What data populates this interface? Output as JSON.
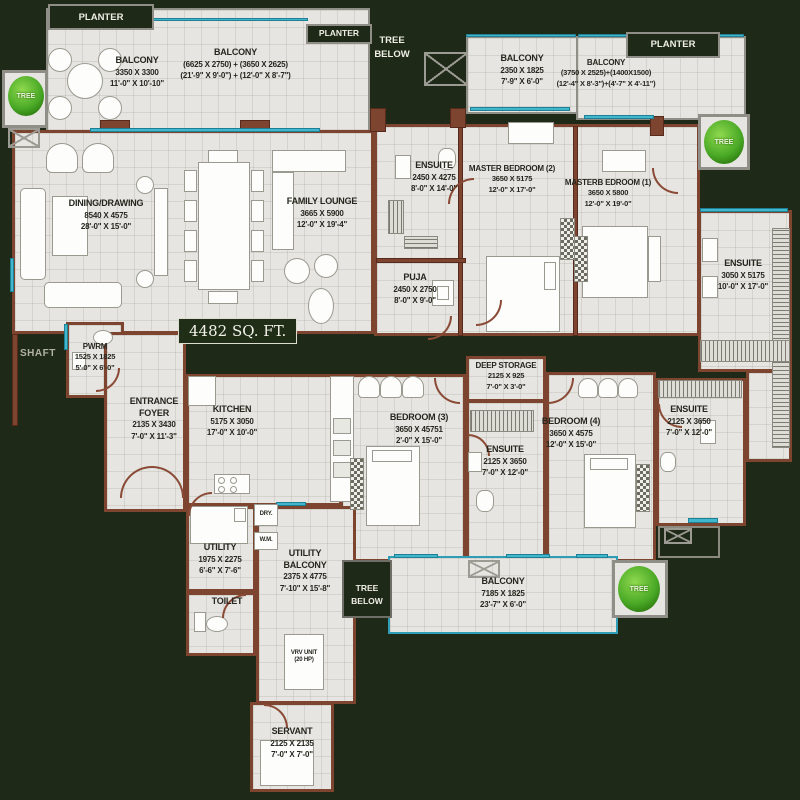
{
  "badge": {
    "area": "4482 SQ. FT."
  },
  "rooms": {
    "balcony_tl": {
      "name": "BALCONY",
      "mm": "3350 X 3300",
      "ft": "11'-0\" X 10'-10\""
    },
    "balcony_tc": {
      "name": "BALCONY",
      "mm": "(6625 X 2750) + (3650 X 2625)",
      "ft": "(21'-9\" X 9'-0\") + (12'-0\" X 8'-7\")"
    },
    "balcony_tr1": {
      "name": "BALCONY",
      "mm": "2350 X 1825",
      "ft": "7'-9\" X 6'-0\""
    },
    "balcony_tr2": {
      "name": "BALCONY",
      "mm": "(3750 X 2525)+(1400X1500)",
      "ft": "(12'-4\" X 8'-3\")+(4'-7\" X 4'-11\")"
    },
    "dining": {
      "name": "DINING/DRAWING",
      "mm": "8540 X 4575",
      "ft": "28'-0\" X 15'-0\""
    },
    "family": {
      "name": "FAMILY LOUNGE",
      "mm": "3665 X 5900",
      "ft": "12'-0\" X 19'-4\""
    },
    "ensuite1": {
      "name": "ENSUITE",
      "mm": "2450 X 4275",
      "ft": "8'-0\" X 14'-0\""
    },
    "master2": {
      "name": "MASTER BEDROOM (2)",
      "mm": "3650 X 5175",
      "ft": "12'-0\" X 17'-0\""
    },
    "master1": {
      "name": "MASTERB EDROOM (1)",
      "mm": "3650 X 5800",
      "ft": "12'-0\" X 19'-0\""
    },
    "ensuite_m1": {
      "name": "ENSUITE",
      "mm": "3050 X 5175",
      "ft": "10'-0\" X 17'-0\""
    },
    "puja": {
      "name": "PUJA",
      "mm": "2450 X 2750",
      "ft": "8'-0\" X 9'-0\""
    },
    "pwrm": {
      "name": "PWRM",
      "mm": "1525 X 1825",
      "ft": "5'-0\" X 6'-0\""
    },
    "entrance": {
      "name": "ENTRANCE FOYER",
      "mm": "2135 X 3430",
      "ft": "7'-0\" X 11'-3\""
    },
    "kitchen": {
      "name": "KITCHEN",
      "mm": "5175 X 3050",
      "ft": "17'-0\" X 10'-0\""
    },
    "bedroom3": {
      "name": "BEDROOM (3)",
      "mm": "3650 X 45751",
      "ft": "2'-0\" X 15'-0\""
    },
    "deep_storage": {
      "name": "DEEP STORAGE",
      "mm": "2125 X 925",
      "ft": "7'-0\" X 3'-0\""
    },
    "ensuite_b3": {
      "name": "ENSUITE",
      "mm": "2125 X 3650",
      "ft": "7'-0\" X 12'-0\""
    },
    "bedroom4": {
      "name": "BEDROOM (4)",
      "mm": "3650 X 4575",
      "ft": "12'-0\" X 15'-0\""
    },
    "ensuite_b4": {
      "name": "ENSUITE",
      "mm": "2125 X 3650",
      "ft": "7'-0\" X 12'-0\""
    },
    "utility": {
      "name": "UTILITY",
      "mm": "1975 X 2275",
      "ft": "6'-6\" X 7'-6\""
    },
    "utility_balcony": {
      "name": "UTILITY BALCONY",
      "mm": "2375 X 4775",
      "ft": "7'-10\" X 15'-8\""
    },
    "toilet": {
      "name": "TOILET"
    },
    "dry": {
      "name": "DRY."
    },
    "wm": {
      "name": "W.M."
    },
    "vrv": {
      "name": "VRV UNIT",
      "mm": "(20 HP)"
    },
    "servant": {
      "name": "SERVANT",
      "mm": "2125 X 2135",
      "ft": "7'-0\" X 7'-0\""
    },
    "balcony_b": {
      "name": "BALCONY",
      "mm": "7185 X 1825",
      "ft": "23'-7\" X 6'-0\""
    }
  },
  "annotations": {
    "planter1": "PLANTER",
    "planter2": "PLANTER",
    "planter3": "PLANTER",
    "tree_below_top": "TREE BELOW",
    "tree_below_bottom": "TREE BELOW",
    "shaft": "SHAFT",
    "tree": "TREE"
  },
  "colors": {
    "background": "#1e2917",
    "floor": "#e6e5e1",
    "wall": "#7d4430",
    "window": "#41b7ce",
    "balcony_rail": "#2e9db5",
    "tree": "#4aa926",
    "label_text": "#26261f",
    "light_text": "#efeee6"
  }
}
